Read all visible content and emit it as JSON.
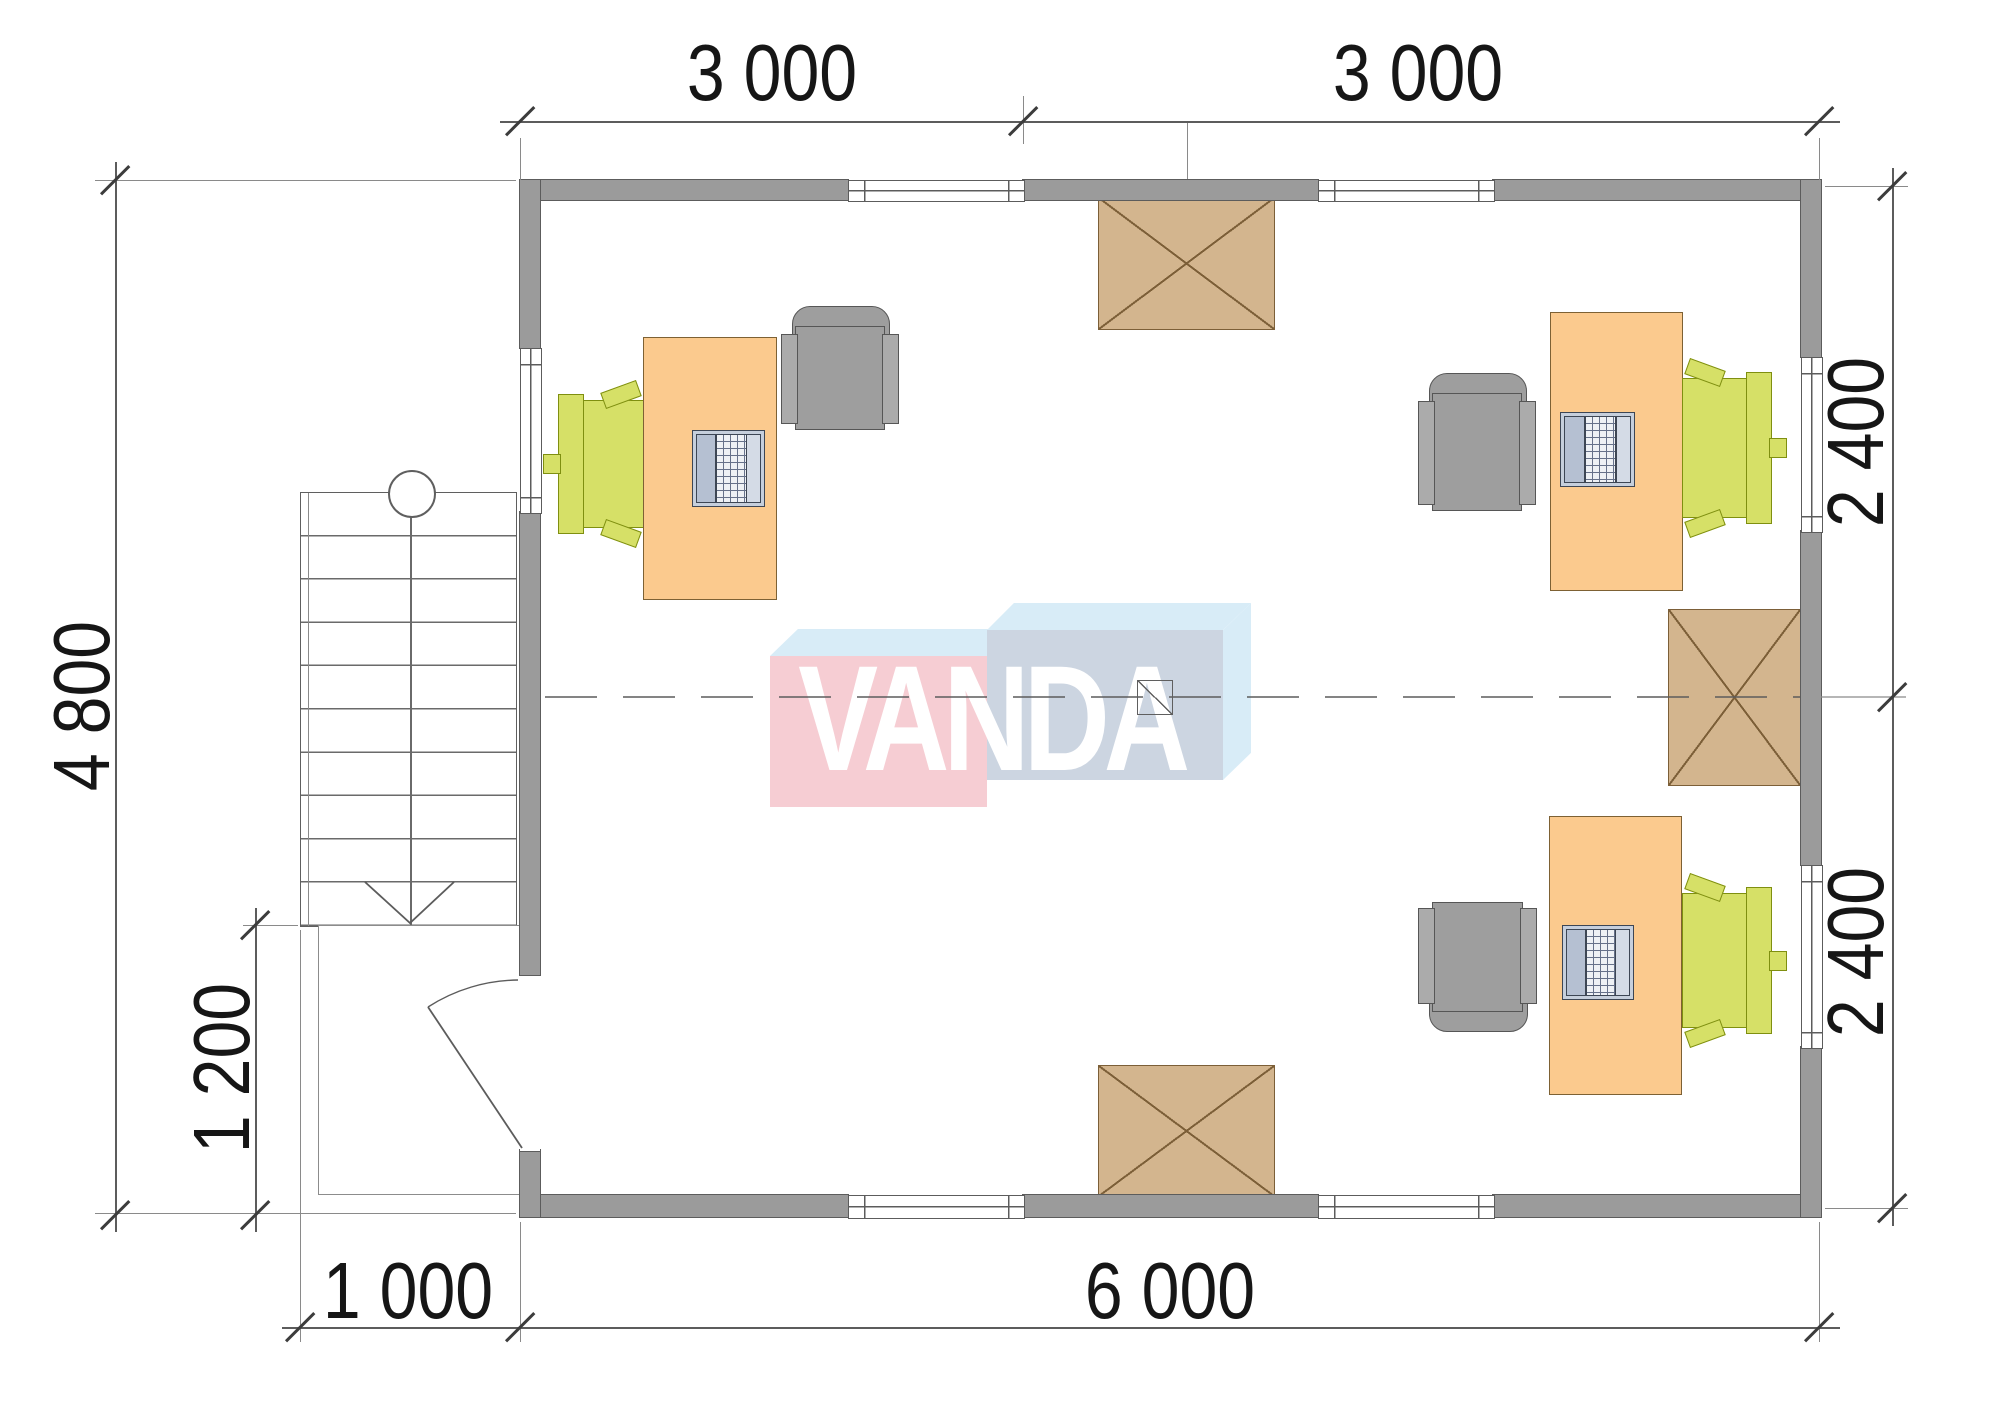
{
  "watermark": {
    "text": "VANDA"
  },
  "dimensions": {
    "top": [
      {
        "label": "3 000"
      },
      {
        "label": "3 000"
      }
    ],
    "bottom": [
      {
        "label": "1 000"
      },
      {
        "label": "6 000"
      }
    ],
    "left": [
      {
        "label": "4 800"
      },
      {
        "label": "1 200"
      }
    ],
    "right": [
      {
        "label": "2 400"
      },
      {
        "label": "2 400"
      }
    ]
  },
  "colors": {
    "wall": "#9b9b9b",
    "wall_outline": "#5c5c5c",
    "line": "#5c5c5c",
    "text": "#161616",
    "desk": "#fbca8e",
    "chair_green": "#d6e067",
    "chair_green_border": "#7f8f10",
    "armchair": "#9e9e9e",
    "armchair_border": "#565656",
    "laptop": "#c6cfdc",
    "shaft": "#d3b58e",
    "shaft_border": "#7c5f38",
    "logo_pink": "#f6cdd3",
    "logo_blue_face": "#ccd5e1",
    "logo_blue_top": "#d8ecf7"
  }
}
